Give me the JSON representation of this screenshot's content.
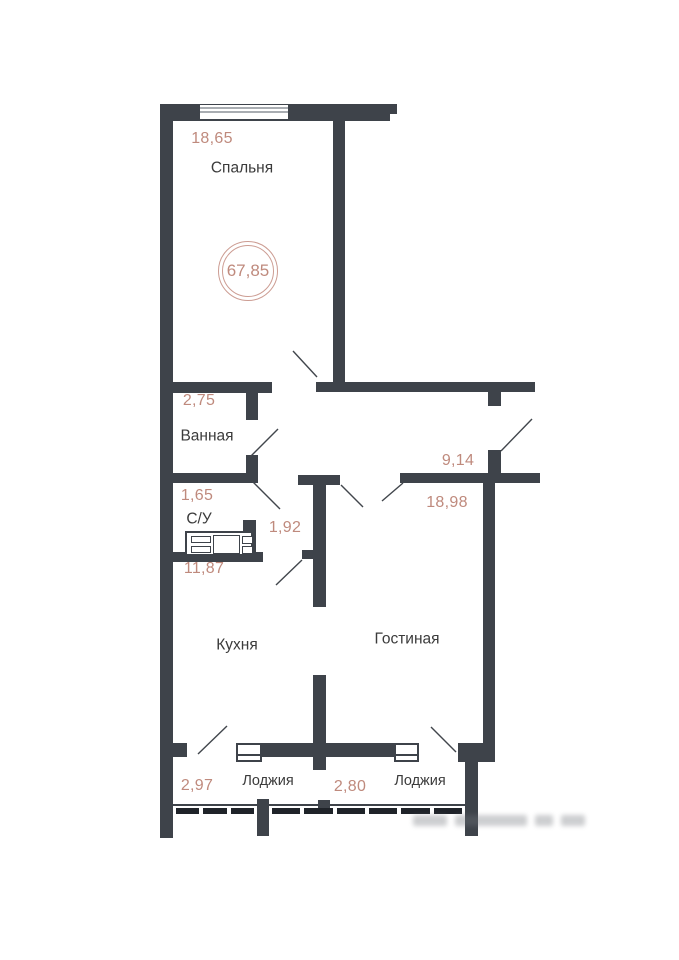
{
  "plan": {
    "total_area": "67,85",
    "rooms": {
      "bedroom": {
        "name": "Спальня",
        "area": "18,65"
      },
      "bathroom": {
        "name": "Ванная",
        "area": "2,75"
      },
      "wc": {
        "name": "С/У",
        "area": "1,65"
      },
      "corridor": {
        "area": "1,92"
      },
      "hallway": {
        "area": "9,14"
      },
      "kitchen": {
        "name": "Кухня",
        "area": "11,87"
      },
      "living": {
        "name": "Гостиная",
        "area": "18,98"
      },
      "loggia1": {
        "name": "Лоджия",
        "area": "2,97"
      },
      "loggia2": {
        "name": "Лоджия",
        "area": "2,80"
      }
    },
    "colors": {
      "wall": "#3e434a",
      "dimension_text": "#bf8a7d",
      "room_text": "#3b3b3b",
      "area_circle": "#cc9c92",
      "background": "#ffffff"
    }
  }
}
